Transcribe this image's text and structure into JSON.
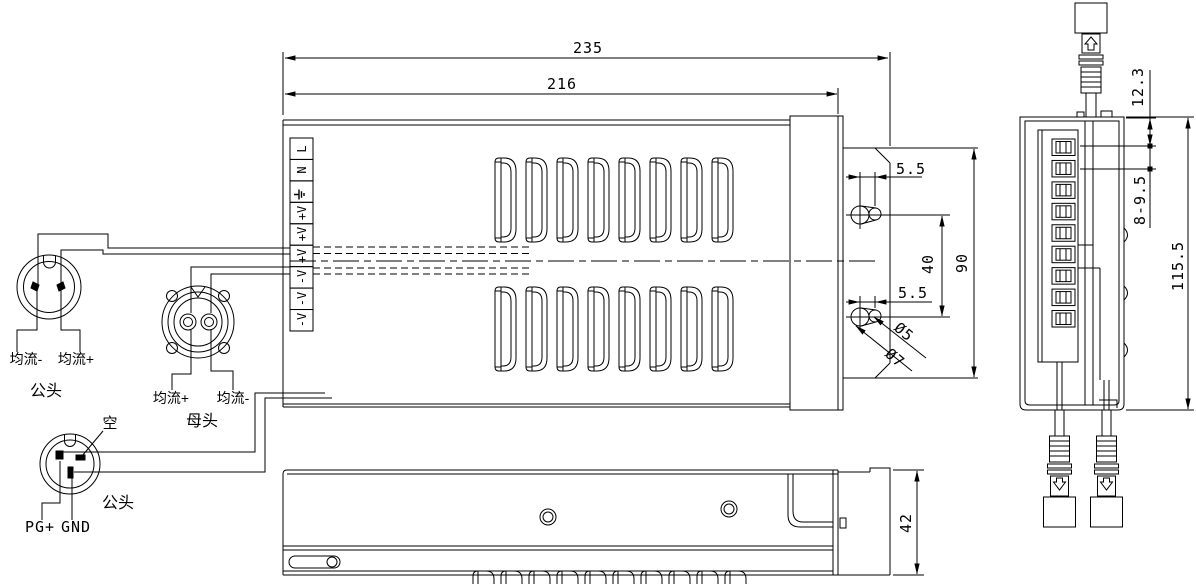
{
  "title": "power-supply-dimension-drawing",
  "dimensions": {
    "width_total": "235",
    "width_body": "216",
    "slot_offset_top": "5.5",
    "slot_offset_bottom": "5.5",
    "slot_spacing": "40",
    "bracket_height": "90",
    "hole_small": "Ø5",
    "hole_large": "Ø7",
    "top_offset": "12.3",
    "terminal_pitch": "8-9.5",
    "side_height": "115.5",
    "base_height": "42"
  },
  "terminal_labels": [
    "L",
    "N",
    "⏚",
    "+V",
    "+V",
    "+V",
    "-V",
    "-V",
    "-V"
  ],
  "connector_a": {
    "wire_left": "均流-",
    "wire_right": "均流+",
    "label": "公头"
  },
  "connector_b": {
    "wire_left": "均流+",
    "wire_right": "均流-",
    "label": "母头"
  },
  "connector_c": {
    "pin_empty": "空",
    "label": "公头",
    "wire_left": "PG+",
    "wire_right": "GND"
  },
  "vents": {
    "top_view_cols": 8,
    "top_view_rows": 2,
    "front_view_cols": 10
  }
}
